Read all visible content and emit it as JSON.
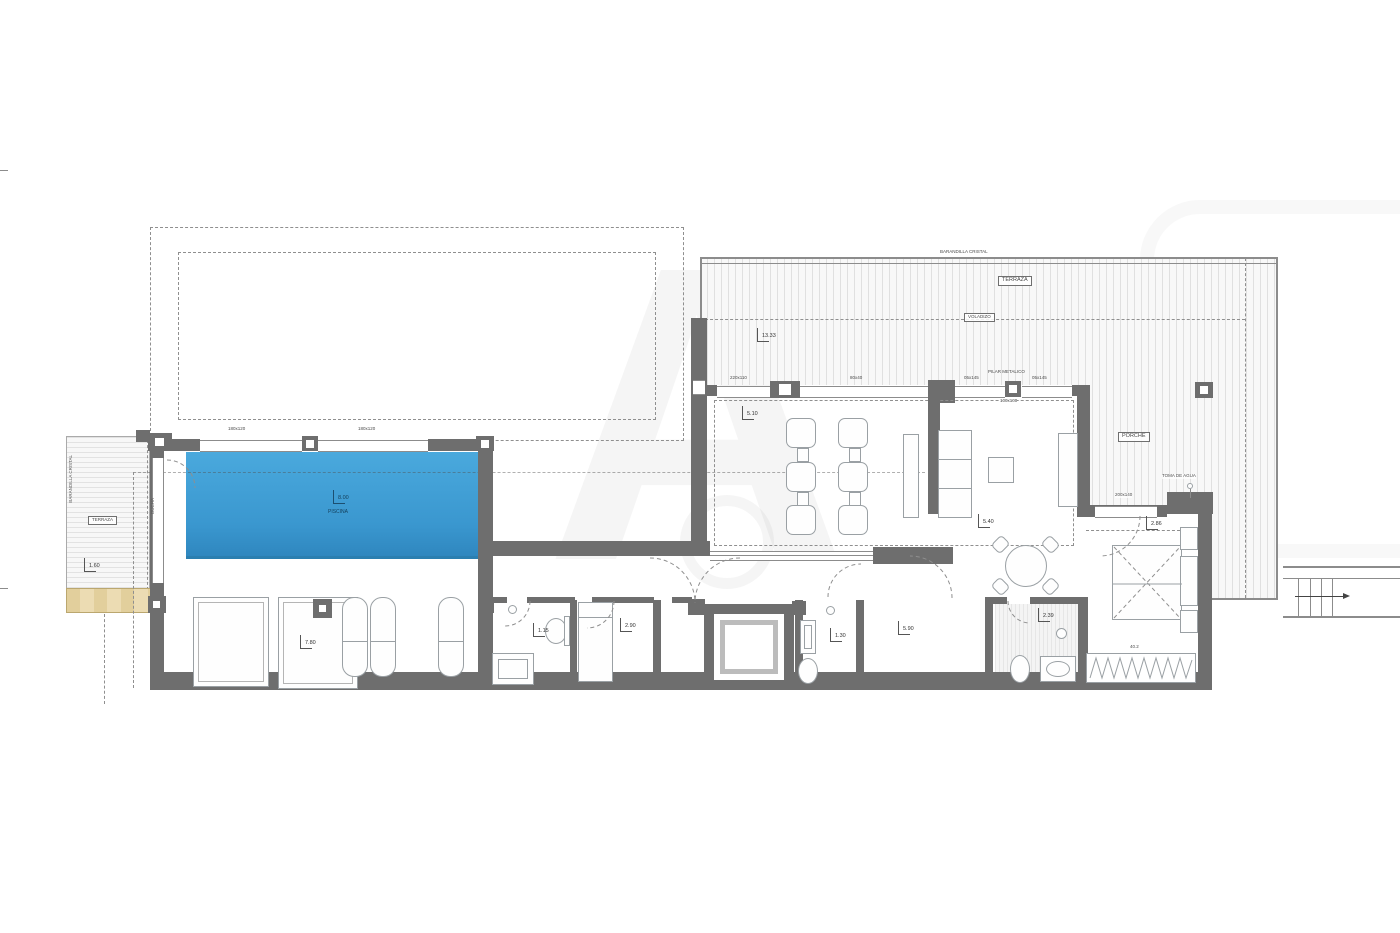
{
  "title": "Villa floor plan",
  "watermark": {
    "letter": "A"
  },
  "colors": {
    "wall": "#6E6E6E",
    "pool": "#3D9ED6",
    "pool_edge": "#2B7FB0",
    "sand": "#E9D8AC",
    "line": "#8C8C8C"
  },
  "labels": {
    "barandilla_top": "BARANDILLA CRISTAL",
    "terraza_top": "TERRAZA",
    "voladizo": "VOLADIZO",
    "porche": "PORCHE",
    "toma_de_agua": "TOMA DE AGUA",
    "pilar_metalico": "PILAR METALICO",
    "pilar_size": "100x100",
    "terraza_left": "TERRAZA",
    "barandilla_left": "BARANDILLA CRISTAL",
    "ducha": "DUCHA",
    "piscina": "PISCINA"
  },
  "dims": {
    "terrace": "13.33",
    "pool": "8.00",
    "salon": "5.10",
    "dining": "5.40",
    "hall": "5.90",
    "deck": "7.80",
    "terrace_left": "1.60",
    "bath_left": "1.15",
    "bed_center": "2.90",
    "bath_mid": "1.30",
    "bath_right": "2.39",
    "bed_right": "2.86",
    "wardrobe": "40.2"
  },
  "windows": {
    "pool_w1": "180x120",
    "pool_w2": "180x120",
    "salon_w1": "220x110",
    "salon_w2": "80x40",
    "dining_w1": "05x145",
    "dining_w2": "05x145",
    "bedroom_w": "200x140"
  }
}
